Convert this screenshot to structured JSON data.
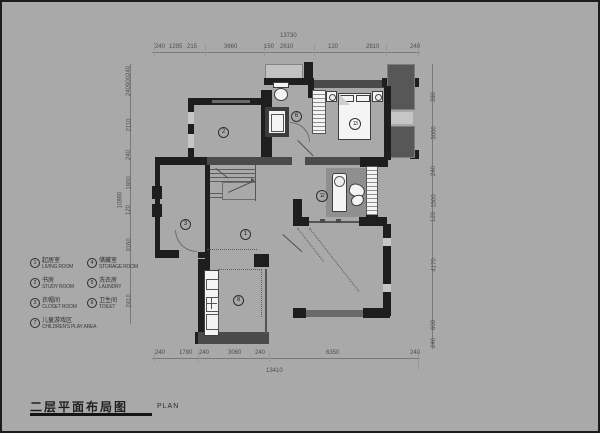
{
  "title": {
    "cn": "二层平面布局图",
    "en": "PLAN"
  },
  "legend": {
    "items_col1": [
      {
        "num": "1",
        "cn": "起居室",
        "en": "LIVING ROOM"
      },
      {
        "num": "2",
        "cn": "书房",
        "en": "STUDY ROOM"
      },
      {
        "num": "3",
        "cn": "衣帽间",
        "en": "CLOSET ROOM"
      }
    ],
    "items_col2": [
      {
        "num": "4",
        "cn": "储藏室",
        "en": "STORAGE ROOM"
      },
      {
        "num": "5",
        "cn": "洗衣房",
        "en": "LAUNDRY"
      },
      {
        "num": "6",
        "cn": "卫生间",
        "en": "TOILET"
      }
    ],
    "item_wide": {
      "num": "7",
      "cn": "儿童游戏区",
      "en": "CHILDREN'S PLAY AREA"
    }
  },
  "room_labels": {
    "hall": "1",
    "study": "2",
    "closet": "3",
    "bath": "6",
    "bed1": "13",
    "bed2": "12",
    "playroom": "8"
  },
  "dims": {
    "top": {
      "total": "13730",
      "segs": [
        "240",
        "1295",
        "215",
        "3660",
        "150",
        "2610",
        "120",
        "2810",
        "240"
      ]
    },
    "bottom": {
      "total": "13410",
      "segs": [
        "240",
        "1790",
        "240",
        "3060",
        "240",
        "6350",
        "240"
      ]
    },
    "left": {
      "total": "10860",
      "segs": [
        "240",
        "900",
        "240",
        "2110",
        "240",
        "1800",
        "120",
        "3160",
        "2410"
      ]
    },
    "right": {
      "segs": [
        "390",
        "3000",
        "240",
        "1500",
        "120",
        "4170",
        "600",
        "240"
      ]
    }
  }
}
